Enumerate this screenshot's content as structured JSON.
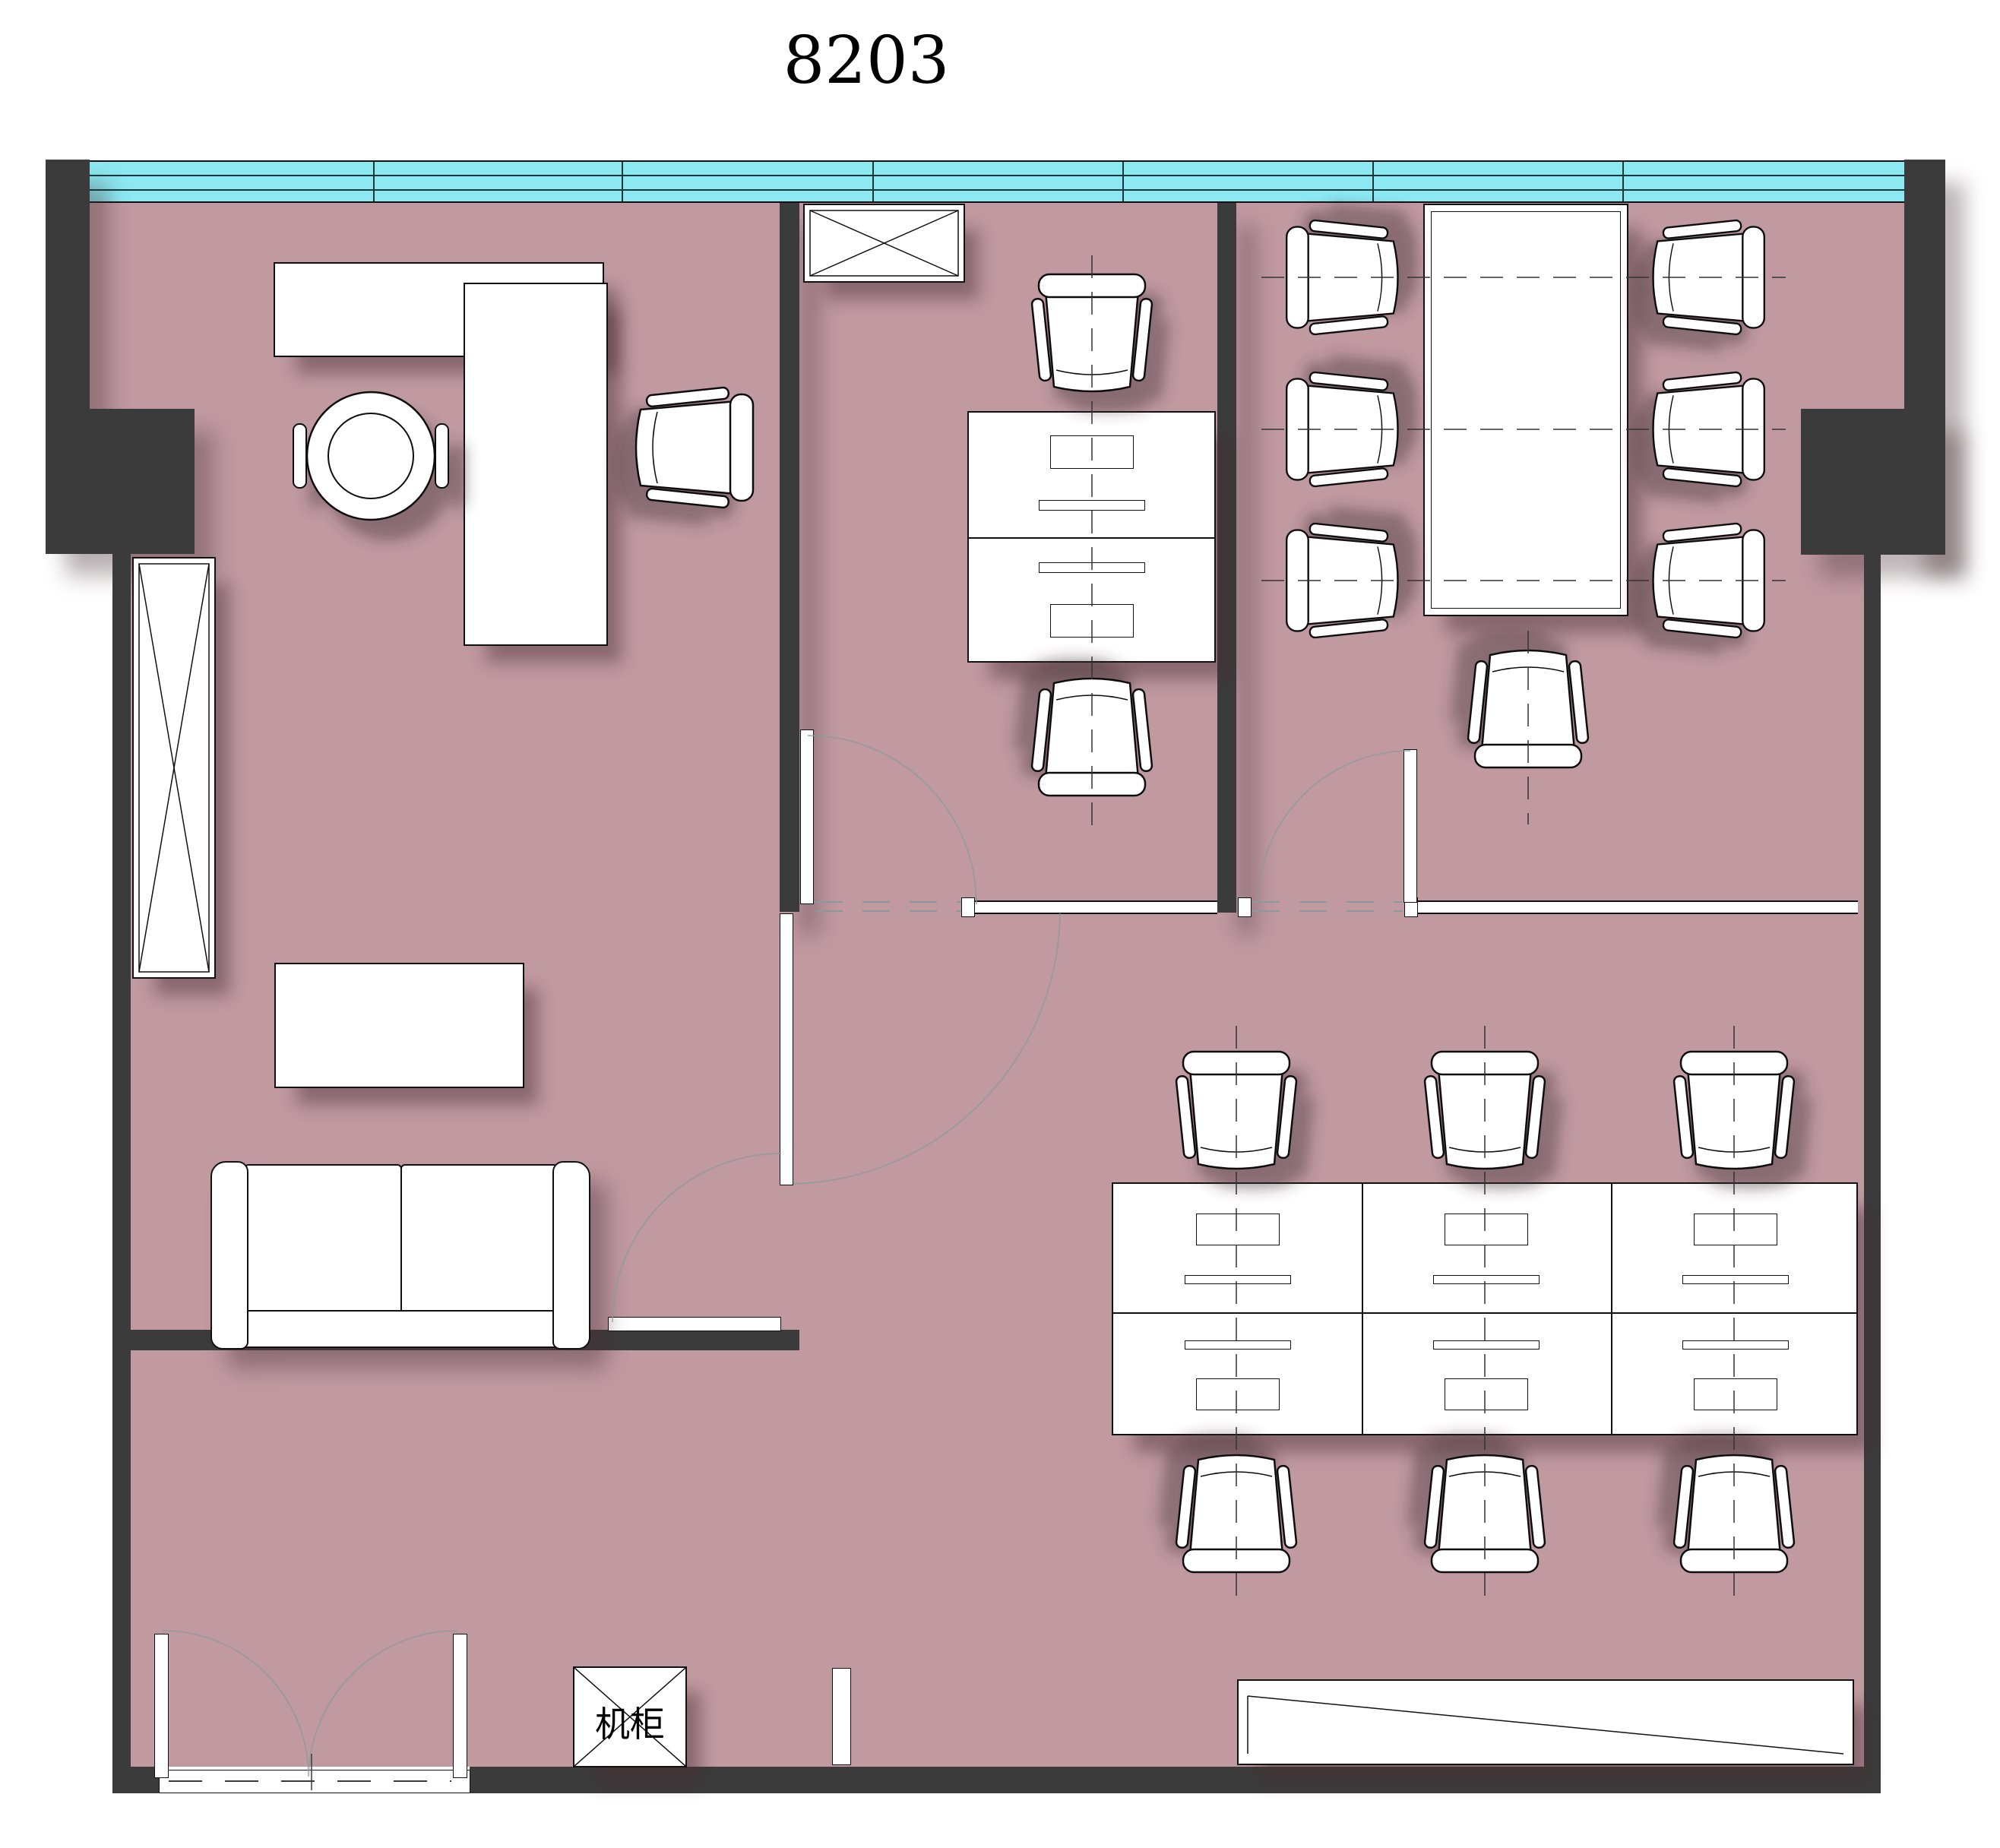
{
  "title": "8203",
  "labels": {
    "server_cabinet": "机柜"
  },
  "colors": {
    "floor": "#c099a1",
    "wall": "#3b3b3b",
    "window": "#8ce9f2",
    "outline": "#111111",
    "swing": "#8a999b",
    "centerline": "#333333",
    "furniture": "#ffffff"
  },
  "window_wall": {
    "rails": 3,
    "panes": 7,
    "side": "top"
  },
  "rooms": [
    {
      "name": "manager-office",
      "furniture": [
        "l-shaped-desk",
        "executive-chair",
        "guest-chair",
        "tall-storage-cabinet",
        "coffee-table",
        "two-seat-sofa"
      ],
      "doors": [
        "swing-door-to-corridor",
        "sliding-panel"
      ]
    },
    {
      "name": "middle-office",
      "furniture": [
        "coat-cabinet",
        "office-chair",
        "double-sided-desk",
        "office-chair"
      ],
      "doors": [
        "swing-door"
      ]
    },
    {
      "name": "meeting-room",
      "furniture": [
        "conference-table",
        "office-chair",
        "office-chair",
        "office-chair",
        "office-chair",
        "office-chair",
        "office-chair",
        "office-chair"
      ],
      "doors": [
        "swing-door"
      ]
    },
    {
      "name": "open-office",
      "furniture": [
        "workstation-block-6-seats",
        "office-chair",
        "office-chair",
        "office-chair",
        "office-chair",
        "office-chair",
        "office-chair",
        "reception-counter"
      ]
    },
    {
      "name": "corridor",
      "furniture": [
        "server-cabinet",
        "double-entry-door"
      ]
    }
  ]
}
